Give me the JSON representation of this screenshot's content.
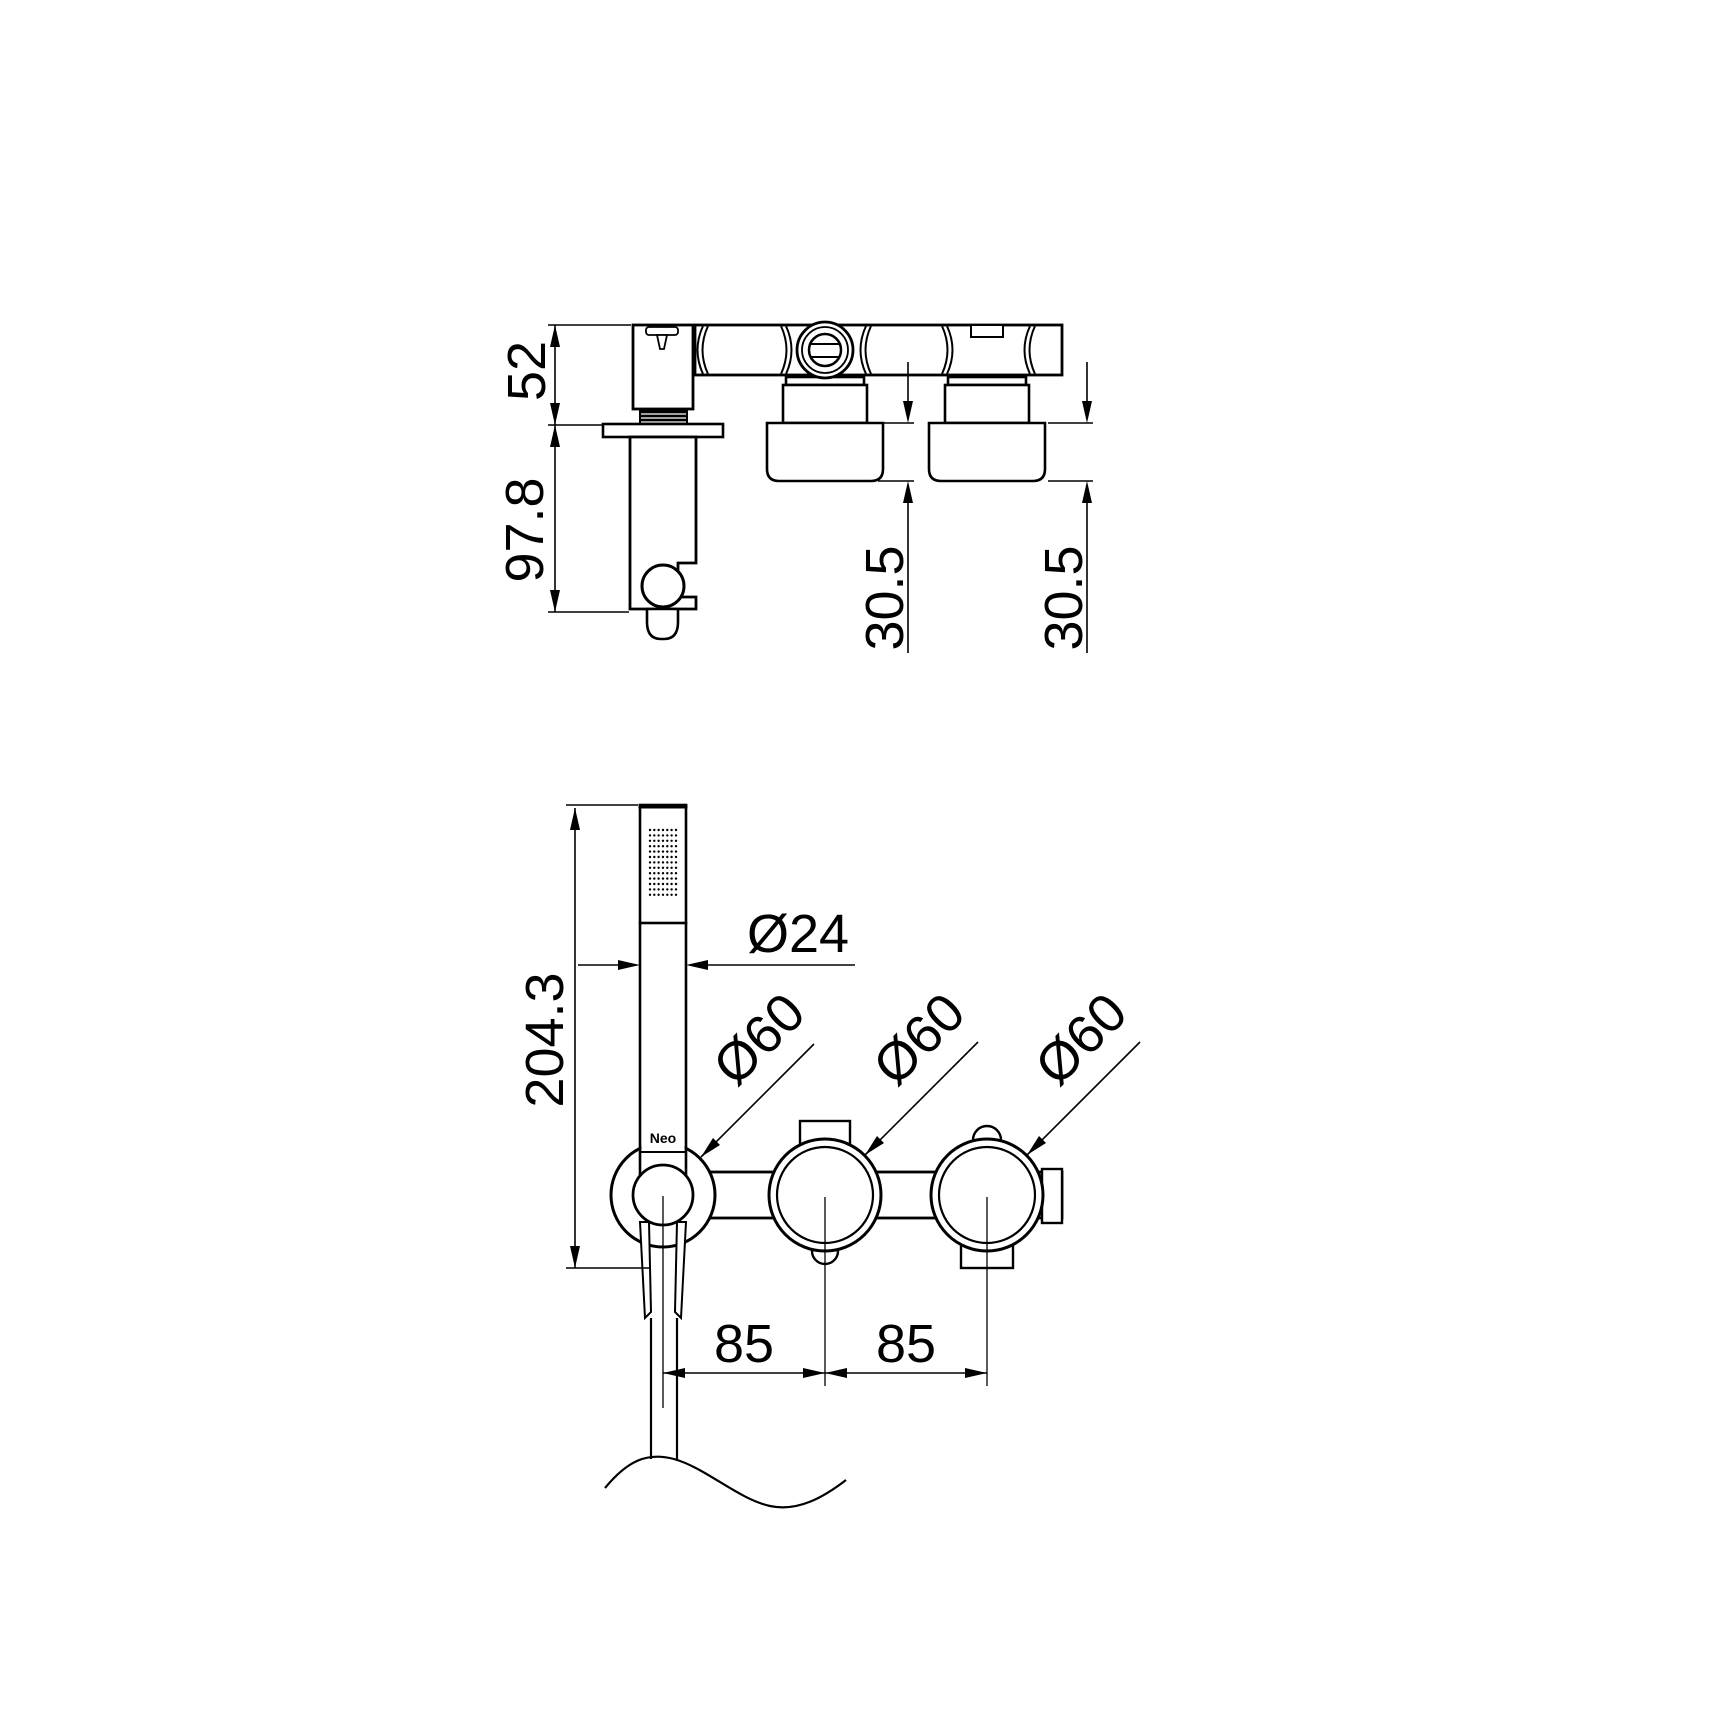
{
  "labels": {
    "brand": "Neo"
  },
  "dimensions": {
    "side_view": {
      "bar_section_height": "52",
      "holder_projection": "97.8",
      "left_cap_height": "30.5",
      "right_cap_height": "30.5"
    },
    "front_view": {
      "handshower_length": "204.3",
      "handshower_diameter": "Ø24",
      "holder_ring_diameter": "Ø60",
      "middle_knob_diameter": "Ø60",
      "right_knob_diameter": "Ø60",
      "holder_to_middle_spacing": "85",
      "middle_to_right_spacing": "85"
    }
  },
  "colors": {
    "line": "#000000",
    "background": "#ffffff"
  }
}
